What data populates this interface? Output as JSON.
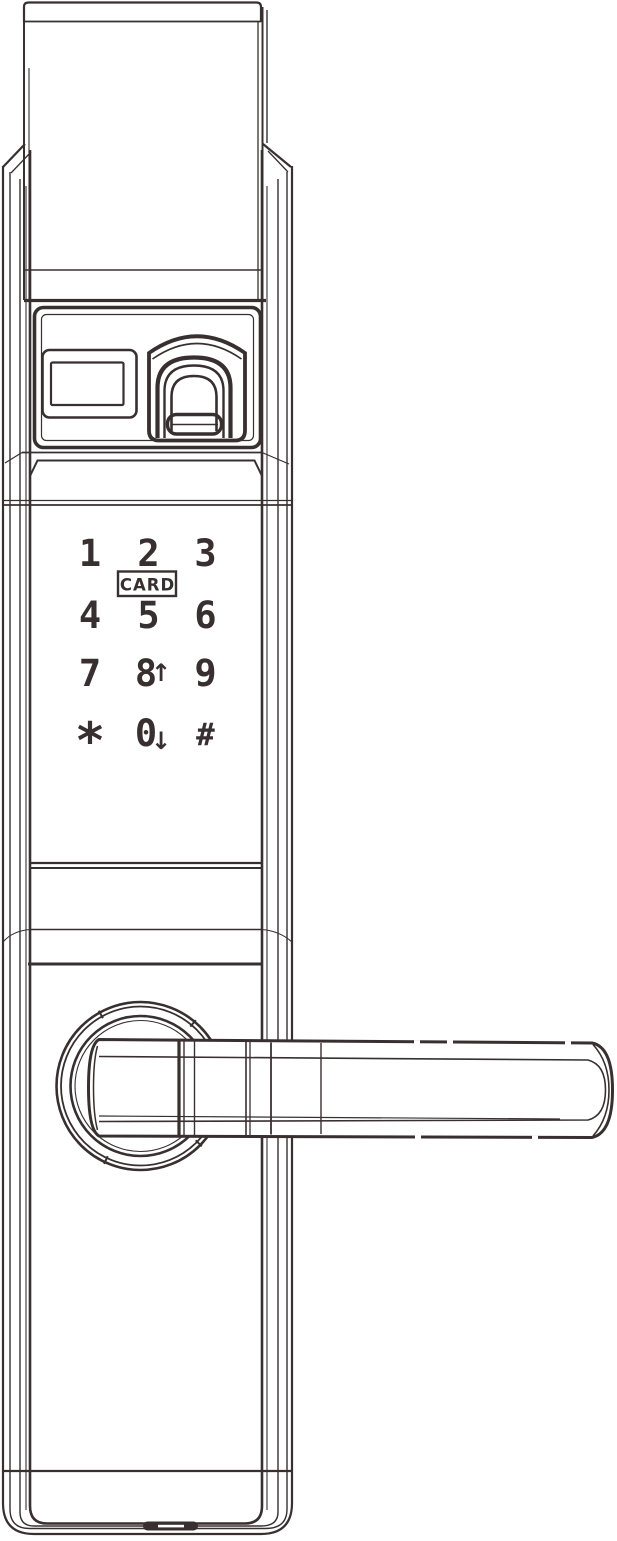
{
  "colors": {
    "line": "#382f31",
    "background": "#ffffff"
  },
  "keypad": {
    "card_label": "CARD",
    "keys": [
      {
        "id": "key-1",
        "digit": "1"
      },
      {
        "id": "key-2",
        "digit": "2"
      },
      {
        "id": "key-3",
        "digit": "3"
      },
      {
        "id": "key-4",
        "digit": "4"
      },
      {
        "id": "key-5",
        "digit": "5"
      },
      {
        "id": "key-6",
        "digit": "6"
      },
      {
        "id": "key-7",
        "digit": "7"
      },
      {
        "id": "key-8",
        "digit": "8",
        "arrow": "↑"
      },
      {
        "id": "key-9",
        "digit": "9"
      },
      {
        "id": "key-star",
        "digit": "*"
      },
      {
        "id": "key-0",
        "digit": "0",
        "arrow": "↓"
      },
      {
        "id": "key-hash",
        "digit": "#"
      }
    ]
  }
}
